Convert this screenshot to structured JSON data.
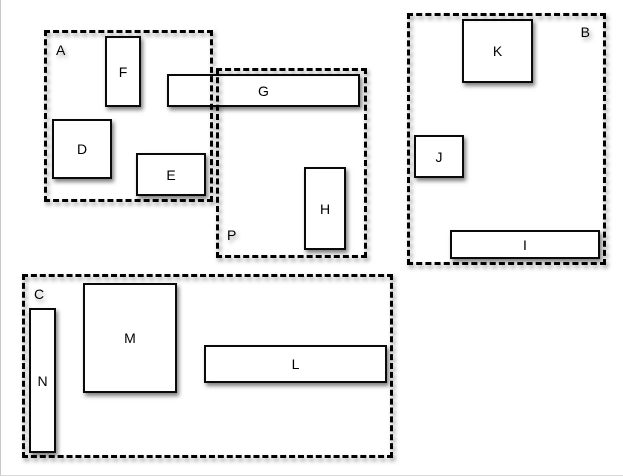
{
  "canvas": {
    "width": 623,
    "height": 476,
    "background": "#ffffff",
    "page_edge_color": "#c8c8c8",
    "stroke_color": "#000000",
    "node_fill": "#ffffff",
    "shadow_color": "rgba(0,0,0,0.45)"
  },
  "regions": [
    {
      "id": "A",
      "label": "A",
      "x": 43,
      "y": 30,
      "w": 169,
      "h": 172,
      "label_pos": "top-left"
    },
    {
      "id": "P",
      "label": "P",
      "x": 215,
      "y": 68,
      "w": 151,
      "h": 190,
      "label_pos": "bottom-left"
    },
    {
      "id": "B",
      "label": "B",
      "x": 406,
      "y": 13,
      "w": 199,
      "h": 252,
      "label_pos": "top-right"
    },
    {
      "id": "C",
      "label": "C",
      "x": 21,
      "y": 274,
      "w": 371,
      "h": 184,
      "label_pos": "top-left"
    }
  ],
  "nodes": [
    {
      "id": "F",
      "label": "F",
      "x": 104,
      "y": 36,
      "w": 36,
      "h": 71
    },
    {
      "id": "D",
      "label": "D",
      "x": 51,
      "y": 119,
      "w": 60,
      "h": 60
    },
    {
      "id": "E",
      "label": "E",
      "x": 135,
      "y": 153,
      "w": 70,
      "h": 43
    },
    {
      "id": "G",
      "label": "G",
      "x": 166,
      "y": 74,
      "w": 193,
      "h": 33
    },
    {
      "id": "H",
      "label": "H",
      "x": 303,
      "y": 167,
      "w": 42,
      "h": 83
    },
    {
      "id": "K",
      "label": "K",
      "x": 461,
      "y": 19,
      "w": 71,
      "h": 64
    },
    {
      "id": "J",
      "label": "J",
      "x": 413,
      "y": 135,
      "w": 50,
      "h": 43
    },
    {
      "id": "I",
      "label": "I",
      "x": 449,
      "y": 230,
      "w": 150,
      "h": 29
    },
    {
      "id": "M",
      "label": "M",
      "x": 82,
      "y": 283,
      "w": 94,
      "h": 110
    },
    {
      "id": "N",
      "label": "N",
      "x": 28,
      "y": 308,
      "w": 27,
      "h": 145
    },
    {
      "id": "L",
      "label": "L",
      "x": 203,
      "y": 345,
      "w": 183,
      "h": 38
    }
  ]
}
